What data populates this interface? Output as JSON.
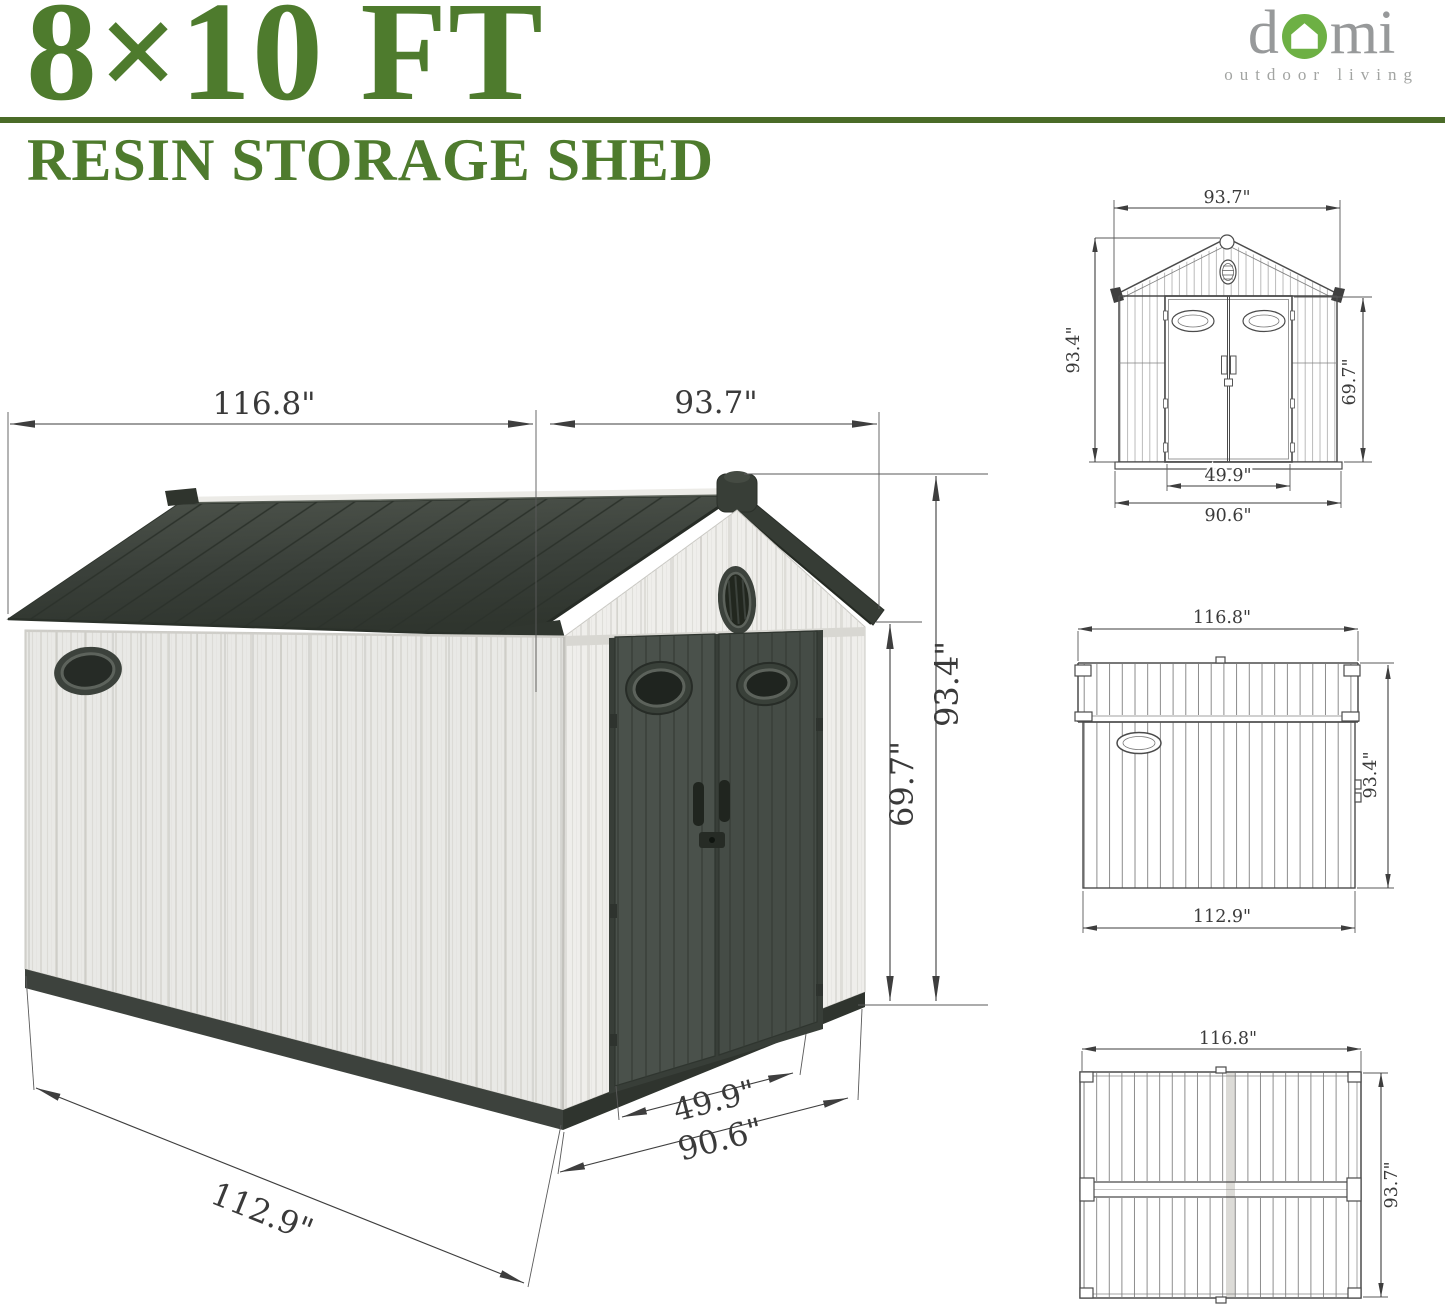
{
  "header": {
    "title": "8×10 FT",
    "subtitle": "RESIN STORAGE SHED",
    "title_color": "#4e7b2d",
    "rule_color": "#4a6b28"
  },
  "brand": {
    "name_pre": "d",
    "name_post": "mi",
    "tagline": "outdoor living",
    "text_color": "#97999a",
    "icon": "house-in-circle-icon",
    "icon_green": "#6db044"
  },
  "hero": {
    "description": "isometric 3D illustration of resin storage shed with dimension callouts",
    "colors": {
      "roof": "#3a403a",
      "walls": "#eaeae7",
      "doors": "#474e48",
      "trim": "#3d423d"
    },
    "dimensions": {
      "roof_length": "116.8\"",
      "front_width": "93.7\"",
      "peak_height": "93.4\"",
      "wall_height": "69.7\"",
      "base_depth": "112.9\"",
      "door_width": "49.9\"",
      "base_width": "90.6\""
    }
  },
  "views": {
    "front": {
      "width_top": "93.7\"",
      "height_total": "93.4\"",
      "door_height": "69.7\"",
      "door_width": "49.9\"",
      "base_width": "90.6\""
    },
    "side": {
      "width_top": "116.8\"",
      "height_total": "93.4\"",
      "base_depth": "112.9\""
    },
    "top": {
      "length": "116.8\"",
      "width": "93.7\""
    }
  }
}
